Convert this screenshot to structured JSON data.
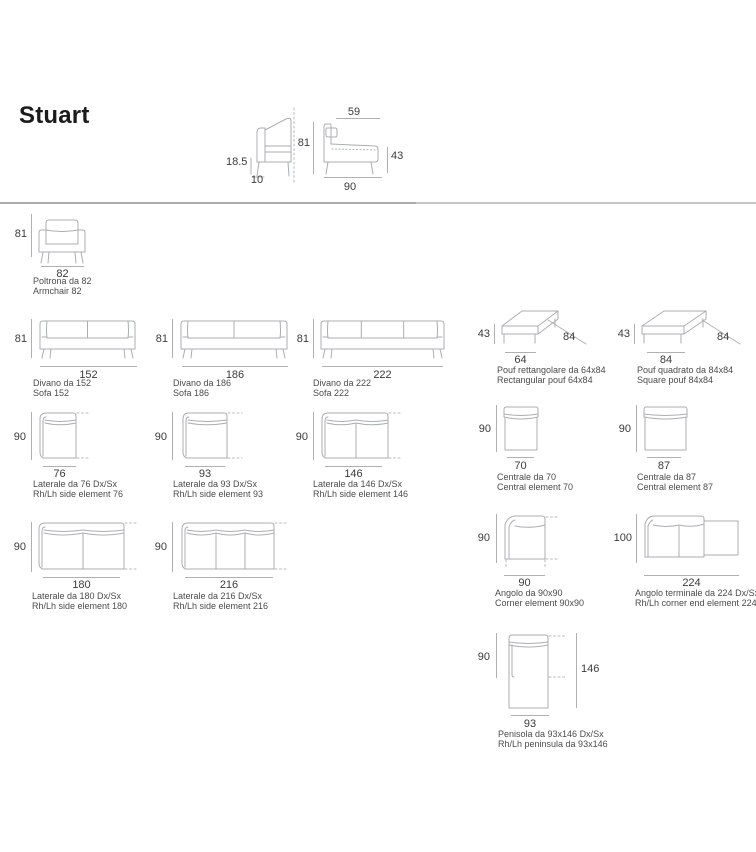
{
  "title": "Stuart",
  "top_detail": {
    "leg_height": "18.5",
    "arm_depth": "10",
    "total_height": "81",
    "seat_depth": "59",
    "seat_height": "43",
    "total_depth": "90"
  },
  "modules": {
    "armchair": {
      "height": "81",
      "width": "82",
      "name_it": "Poltrona da 82",
      "name_en": "Armchair 82"
    },
    "sofa_152": {
      "height": "81",
      "width": "152",
      "name_it": "Divano da 152",
      "name_en": "Sofa 152"
    },
    "sofa_186": {
      "height": "81",
      "width": "186",
      "name_it": "Divano da 186",
      "name_en": "Sofa 186"
    },
    "sofa_222": {
      "height": "81",
      "width": "222",
      "name_it": "Divano da 222",
      "name_en": "Sofa 222"
    },
    "pouf_rect": {
      "height": "43",
      "width": "64",
      "depth": "84",
      "name_it": "Pouf rettangolare da 64x84",
      "name_en": "Rectangular pouf 64x84"
    },
    "pouf_square": {
      "height": "43",
      "width": "84",
      "depth": "84",
      "name_it": "Pouf quadrato da 84x84",
      "name_en": "Square pouf 84x84"
    },
    "side_76": {
      "height": "90",
      "width": "76",
      "name_it": "Laterale da 76 Dx/Sx",
      "name_en": "Rh/Lh side element 76"
    },
    "side_93": {
      "height": "90",
      "width": "93",
      "name_it": "Laterale da 93 Dx/Sx",
      "name_en": "Rh/Lh side element 93"
    },
    "side_146": {
      "height": "90",
      "width": "146",
      "name_it": "Laterale da 146 Dx/Sx",
      "name_en": "Rh/Lh side element 146"
    },
    "central_70": {
      "height": "90",
      "width": "70",
      "name_it": "Centrale da 70",
      "name_en": "Central element 70"
    },
    "central_87": {
      "height": "90",
      "width": "87",
      "name_it": "Centrale da 87",
      "name_en": "Central element 87"
    },
    "side_180": {
      "height": "90",
      "width": "180",
      "name_it": "Laterale da 180 Dx/Sx",
      "name_en": "Rh/Lh side element 180"
    },
    "side_216": {
      "height": "90",
      "width": "216",
      "name_it": "Laterale da 216 Dx/Sx",
      "name_en": "Rh/Lh side element 216"
    },
    "corner_90": {
      "height": "90",
      "width": "90",
      "name_it": "Angolo da 90x90",
      "name_en": "Corner element 90x90"
    },
    "corner_end_224": {
      "height": "100",
      "width": "224",
      "name_it": "Angolo terminale da 224 Dx/Sx",
      "name_en": "Rh/Lh corner end element 224"
    },
    "peninsula_93": {
      "height": "90",
      "width": "93",
      "length": "146",
      "name_it": "Penisola da 93x146 Dx/Sx",
      "name_en": "Rh/Lh peninsula da 93x146"
    }
  }
}
